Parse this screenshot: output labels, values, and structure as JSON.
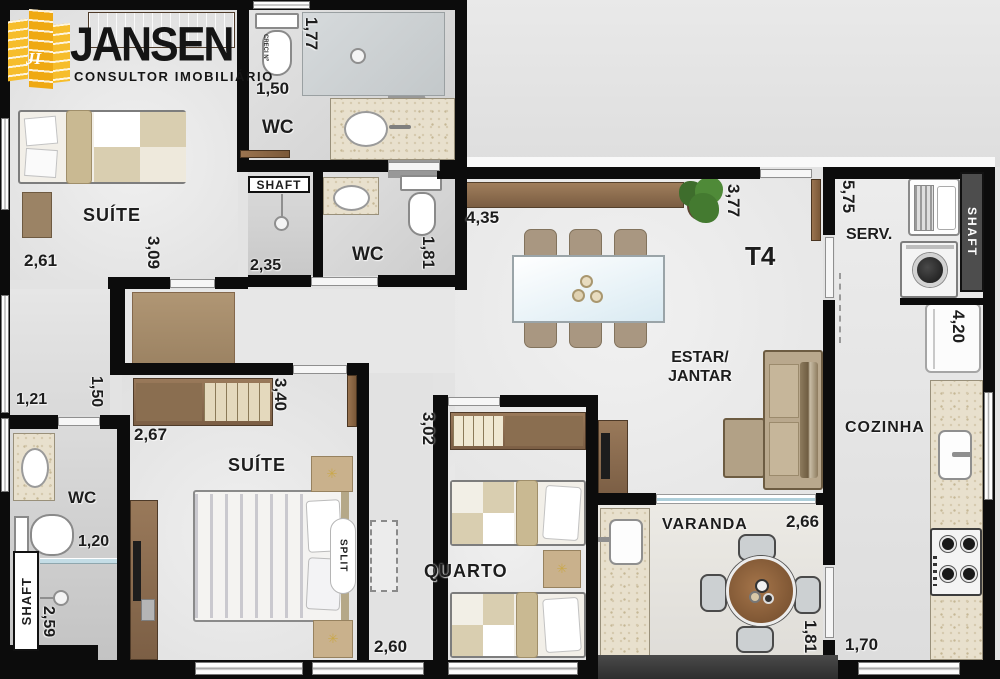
{
  "brand": {
    "name": "JANSEN",
    "tagline": "CONSULTOR IMOBILIÁRIO",
    "creci": "CRECI Nº",
    "monogram": "JI"
  },
  "unit": {
    "label": "T4"
  },
  "rooms": {
    "suite1": {
      "label": "SUÍTE"
    },
    "wc1": {
      "label": "WC"
    },
    "shaft1": {
      "label": "SHAFT"
    },
    "wc2": {
      "label": "WC"
    },
    "estar": {
      "label_line1": "ESTAR/",
      "label_line2": "JANTAR"
    },
    "serv": {
      "label": "SERV."
    },
    "shaft2": {
      "label": "SHAFT"
    },
    "cozinha": {
      "label": "COZINHA"
    },
    "wc3": {
      "label": "WC"
    },
    "shaft3": {
      "label": "SHAFT"
    },
    "suite2": {
      "label": "SUÍTE"
    },
    "split": {
      "label": "SPLIT"
    },
    "quarto": {
      "label": "QUARTO"
    },
    "varanda": {
      "label": "VARANDA"
    }
  },
  "measurements": {
    "wc1_depth": "1,77",
    "wc1_width": "1,50",
    "suite1_width": "2,61",
    "suite1_depth": "3,09",
    "shaft1_width": "2,35",
    "wc2_depth": "1,81",
    "estar_width": "4,35",
    "estar_depth": "3,77",
    "serv_depth": "5,75",
    "cozinha_upper": "4,20",
    "corridor_width": "1,21",
    "corridor_depth": "1,50",
    "suite2_top": "2,67",
    "suite2_depth": "3,40",
    "wc3_width": "1,20",
    "wc3_depth": "2,59",
    "quarto_depth": "3,02",
    "quarto_width": "2,60",
    "varanda_width": "2,66",
    "varanda_depth": "1,81",
    "cozinha_width": "1,70"
  },
  "colors": {
    "wall": "#0c0c0c",
    "brand_yellow": "#f4b71e",
    "glass_blue": "#bdd8e2",
    "wood": "#8c6f4f"
  }
}
